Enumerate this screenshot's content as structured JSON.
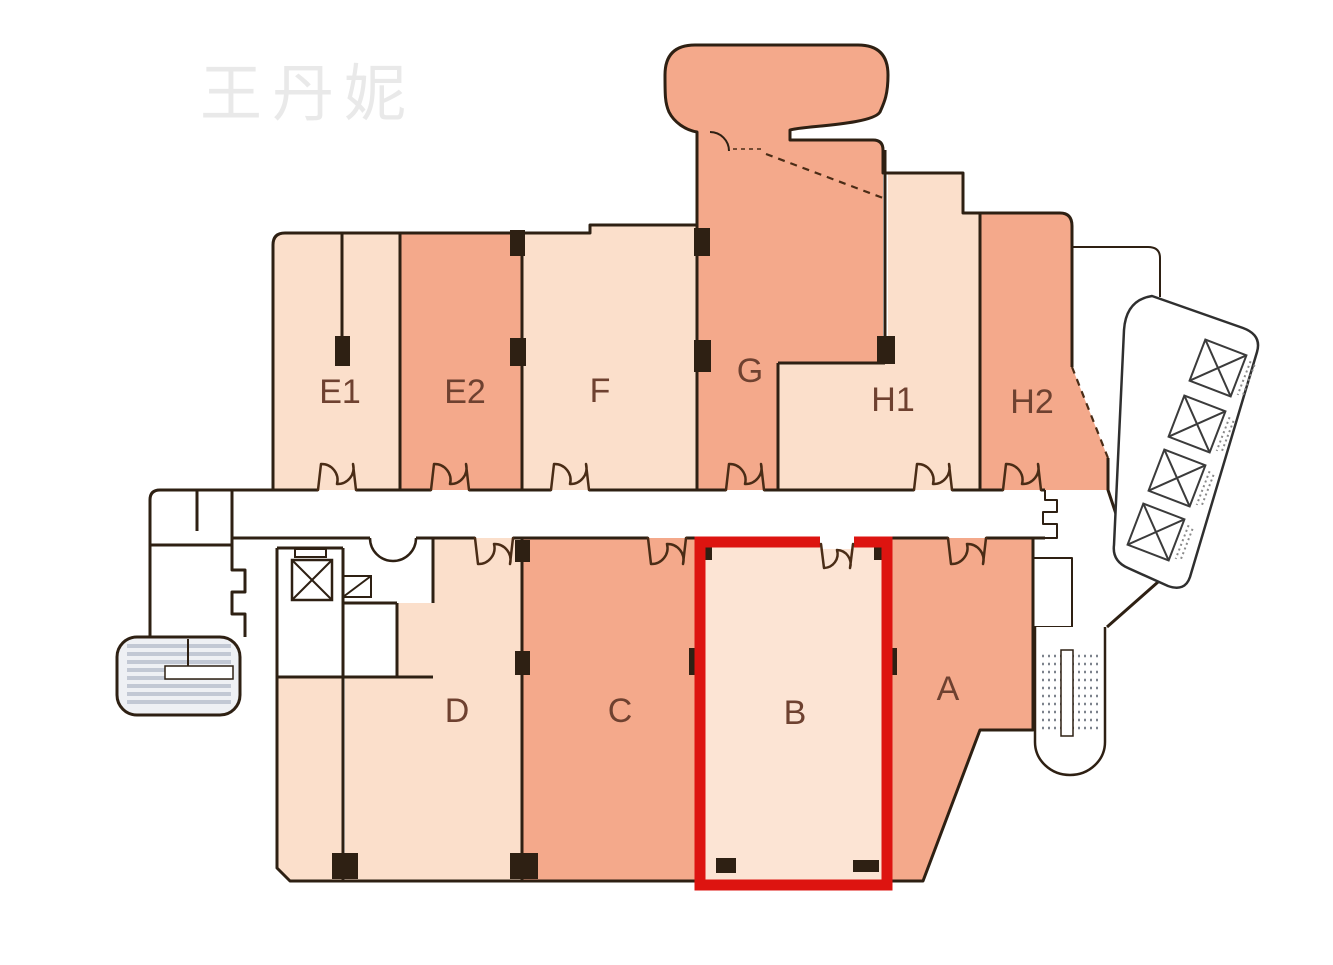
{
  "page": {
    "background": "#ffffff"
  },
  "watermark": {
    "text": "王丹妮",
    "color": "#e9e9e9"
  },
  "floorplan": {
    "selected_unit": "B",
    "highlight_color": "#dd1410",
    "palette": {
      "wall": "#2e2013",
      "unit_light": "#fbdfcb",
      "unit_salmon": "#f4a98b",
      "selected_unit_fill": "#fce4d4",
      "label_text": "#6e4130",
      "stair_fill": "#eef0f4",
      "stair_stripe": "#c2c8d4"
    },
    "units": [
      {
        "id": "E1",
        "label": "E1",
        "tone": "light",
        "selected": false
      },
      {
        "id": "E2",
        "label": "E2",
        "tone": "salmon",
        "selected": false
      },
      {
        "id": "F",
        "label": "F",
        "tone": "light",
        "selected": false
      },
      {
        "id": "G",
        "label": "G",
        "tone": "salmon",
        "selected": false
      },
      {
        "id": "H1",
        "label": "H1",
        "tone": "light",
        "selected": false
      },
      {
        "id": "H2",
        "label": "H2",
        "tone": "salmon",
        "selected": false
      },
      {
        "id": "D",
        "label": "D",
        "tone": "light",
        "selected": false
      },
      {
        "id": "C",
        "label": "C",
        "tone": "salmon",
        "selected": false
      },
      {
        "id": "B",
        "label": "B",
        "tone": "light",
        "selected": true
      },
      {
        "id": "A",
        "label": "A",
        "tone": "salmon",
        "selected": false
      }
    ],
    "features": {
      "elevator_bank_right_cells": 4,
      "elevator_lobby_left_cells": 1,
      "stairwells": 2,
      "corridor": "central horizontal corridor with double-door swings to every unit"
    }
  }
}
